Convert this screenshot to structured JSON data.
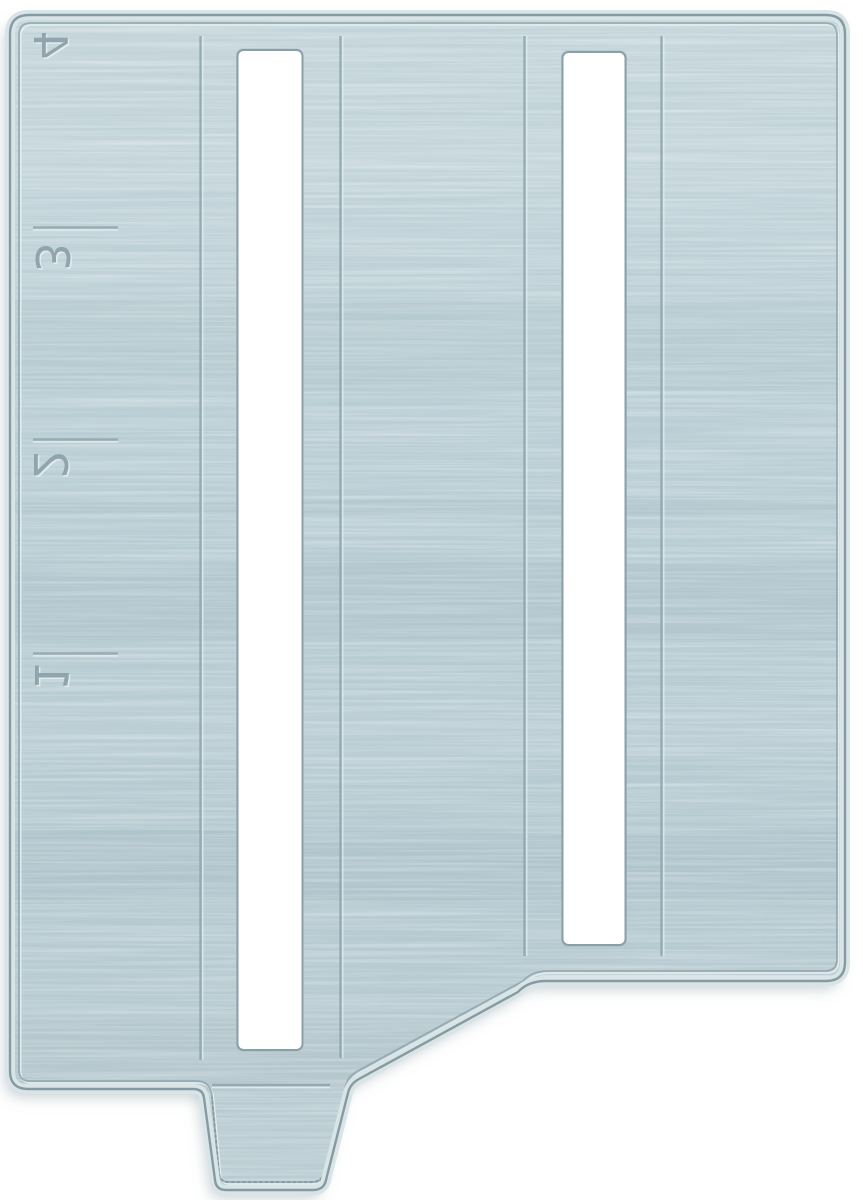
{
  "photo": {
    "subject": "brushed-metal sewing machine slide plate with seam guide scale",
    "background_color": "#ffffff",
    "plate": {
      "scale_numbers": {
        "n4": "4",
        "n3": "3",
        "n2": "2",
        "n1": "1"
      },
      "scale_tick_count": 3,
      "slot_count": 2,
      "groove_count": 4,
      "colors": {
        "plate_base": "#bccfd6",
        "plate_light_streak": "#cfdde2",
        "plate_dark_streak": "#a7bdc6",
        "edge_line": "#7b929b",
        "outer_bevel": "#d9e4e7",
        "inner_border": "#8ea4ad",
        "emboss_highlight": "#e6eef0",
        "groove": "#8ea5ae",
        "engraving": "#8da2ab",
        "slot_fill": "#ffffff",
        "slot_edge": "#8aa0a9",
        "drop_shadow": "#8fa2aa"
      }
    }
  }
}
